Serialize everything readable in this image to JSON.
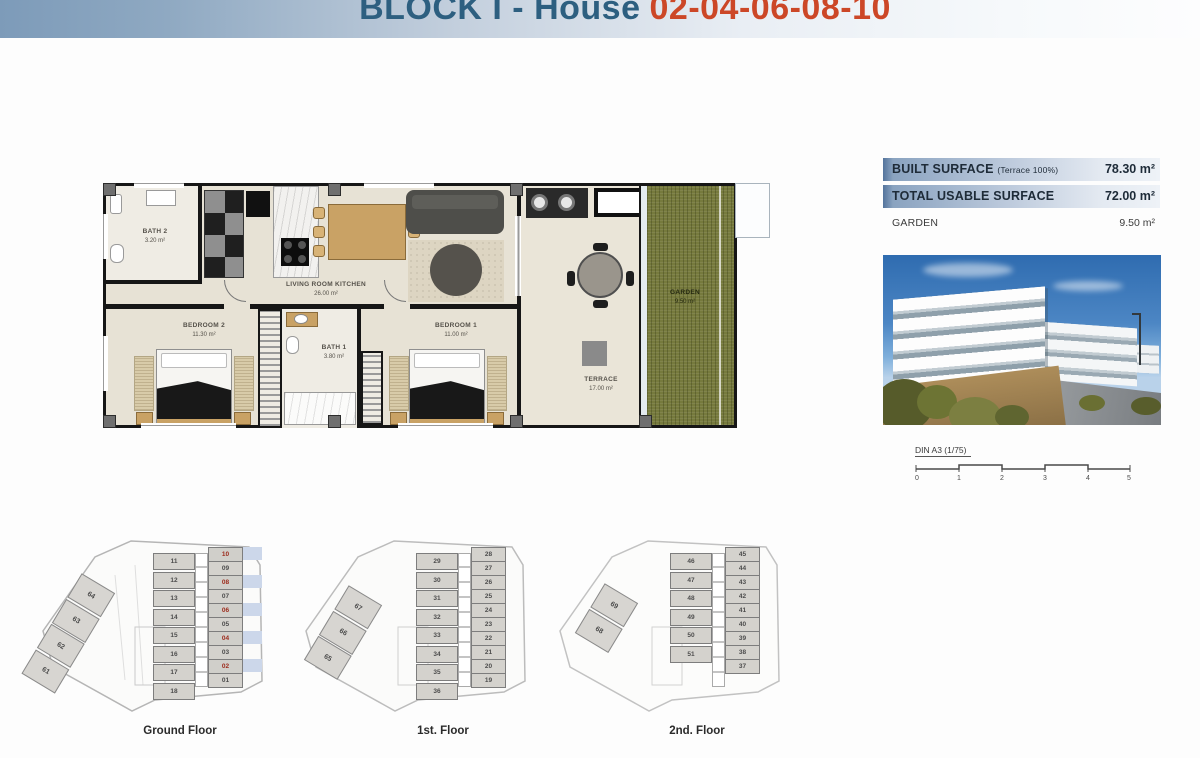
{
  "header": {
    "title_block": "BLOCK I - House",
    "title_numbers": "02-04-06-08-10"
  },
  "plan": {
    "bath2_name": "BATH 2",
    "bath2_area": "3.20 m²",
    "living_name": "LIVING ROOM KITCHEN",
    "living_area": "26.00 m²",
    "bedroom2_name": "BEDROOM 2",
    "bedroom2_area": "11.30 m²",
    "bath1_name": "BATH 1",
    "bath1_area": "3.80 m²",
    "bedroom1_name": "BEDROOM 1",
    "bedroom1_area": "11.00 m²",
    "terrace_name": "TERRACE",
    "terrace_area": "17.00 m²",
    "garden_name": "GARDEN",
    "garden_area": "9.50 m²"
  },
  "surface_table": {
    "rows": [
      {
        "label": "BUILT SURFACE",
        "sublabel": "(Terrace 100%)",
        "value": "78.30 m²"
      },
      {
        "label": "TOTAL USABLE SURFACE",
        "sublabel": "",
        "value": "72.00 m²"
      },
      {
        "label": "GARDEN",
        "sublabel": "",
        "value": "9.50 m²"
      }
    ]
  },
  "scale_bar": {
    "label": "DIN A3 (1/75)",
    "ticks": [
      "0",
      "1",
      "2",
      "3",
      "4",
      "5"
    ]
  },
  "colors": {
    "title_blue": "#2d5f80",
    "title_orange": "#cc4727",
    "table_band_blue": "#54749c",
    "highlight_row_blue": "#ccd7ea",
    "highlight_number_red": "#9c2b1c",
    "garden_green": "#767a3d"
  },
  "floors": [
    {
      "label": "Ground Floor",
      "mid_units": [
        "11",
        "12",
        "13",
        "14",
        "15",
        "16",
        "17",
        "18"
      ],
      "right_units": [
        {
          "n": "10",
          "hl": true
        },
        {
          "n": "09",
          "hl": false
        },
        {
          "n": "08",
          "hl": true
        },
        {
          "n": "07",
          "hl": false
        },
        {
          "n": "06",
          "hl": true
        },
        {
          "n": "05",
          "hl": false
        },
        {
          "n": "04",
          "hl": true
        },
        {
          "n": "03",
          "hl": false
        },
        {
          "n": "02",
          "hl": true
        },
        {
          "n": "01",
          "hl": false
        }
      ],
      "diag_units": [
        "64",
        "63",
        "62",
        "61"
      ]
    },
    {
      "label": "1st. Floor",
      "mid_units": [
        "29",
        "30",
        "31",
        "32",
        "33",
        "34",
        "35",
        "36"
      ],
      "right_units": [
        {
          "n": "28",
          "hl": false
        },
        {
          "n": "27",
          "hl": false
        },
        {
          "n": "26",
          "hl": false
        },
        {
          "n": "25",
          "hl": false
        },
        {
          "n": "24",
          "hl": false
        },
        {
          "n": "23",
          "hl": false
        },
        {
          "n": "22",
          "hl": false
        },
        {
          "n": "21",
          "hl": false
        },
        {
          "n": "20",
          "hl": false
        },
        {
          "n": "19",
          "hl": false
        }
      ],
      "diag_units": [
        "67",
        "66",
        "65"
      ]
    },
    {
      "label": "2nd. Floor",
      "mid_units": [
        "46",
        "47",
        "48",
        "49",
        "50",
        "51"
      ],
      "right_units": [
        {
          "n": "45",
          "hl": false
        },
        {
          "n": "44",
          "hl": false
        },
        {
          "n": "43",
          "hl": false
        },
        {
          "n": "42",
          "hl": false
        },
        {
          "n": "41",
          "hl": false
        },
        {
          "n": "40",
          "hl": false
        },
        {
          "n": "39",
          "hl": false
        },
        {
          "n": "38",
          "hl": false
        },
        {
          "n": "37",
          "hl": false
        }
      ],
      "diag_units": [
        "69",
        "68"
      ]
    }
  ]
}
